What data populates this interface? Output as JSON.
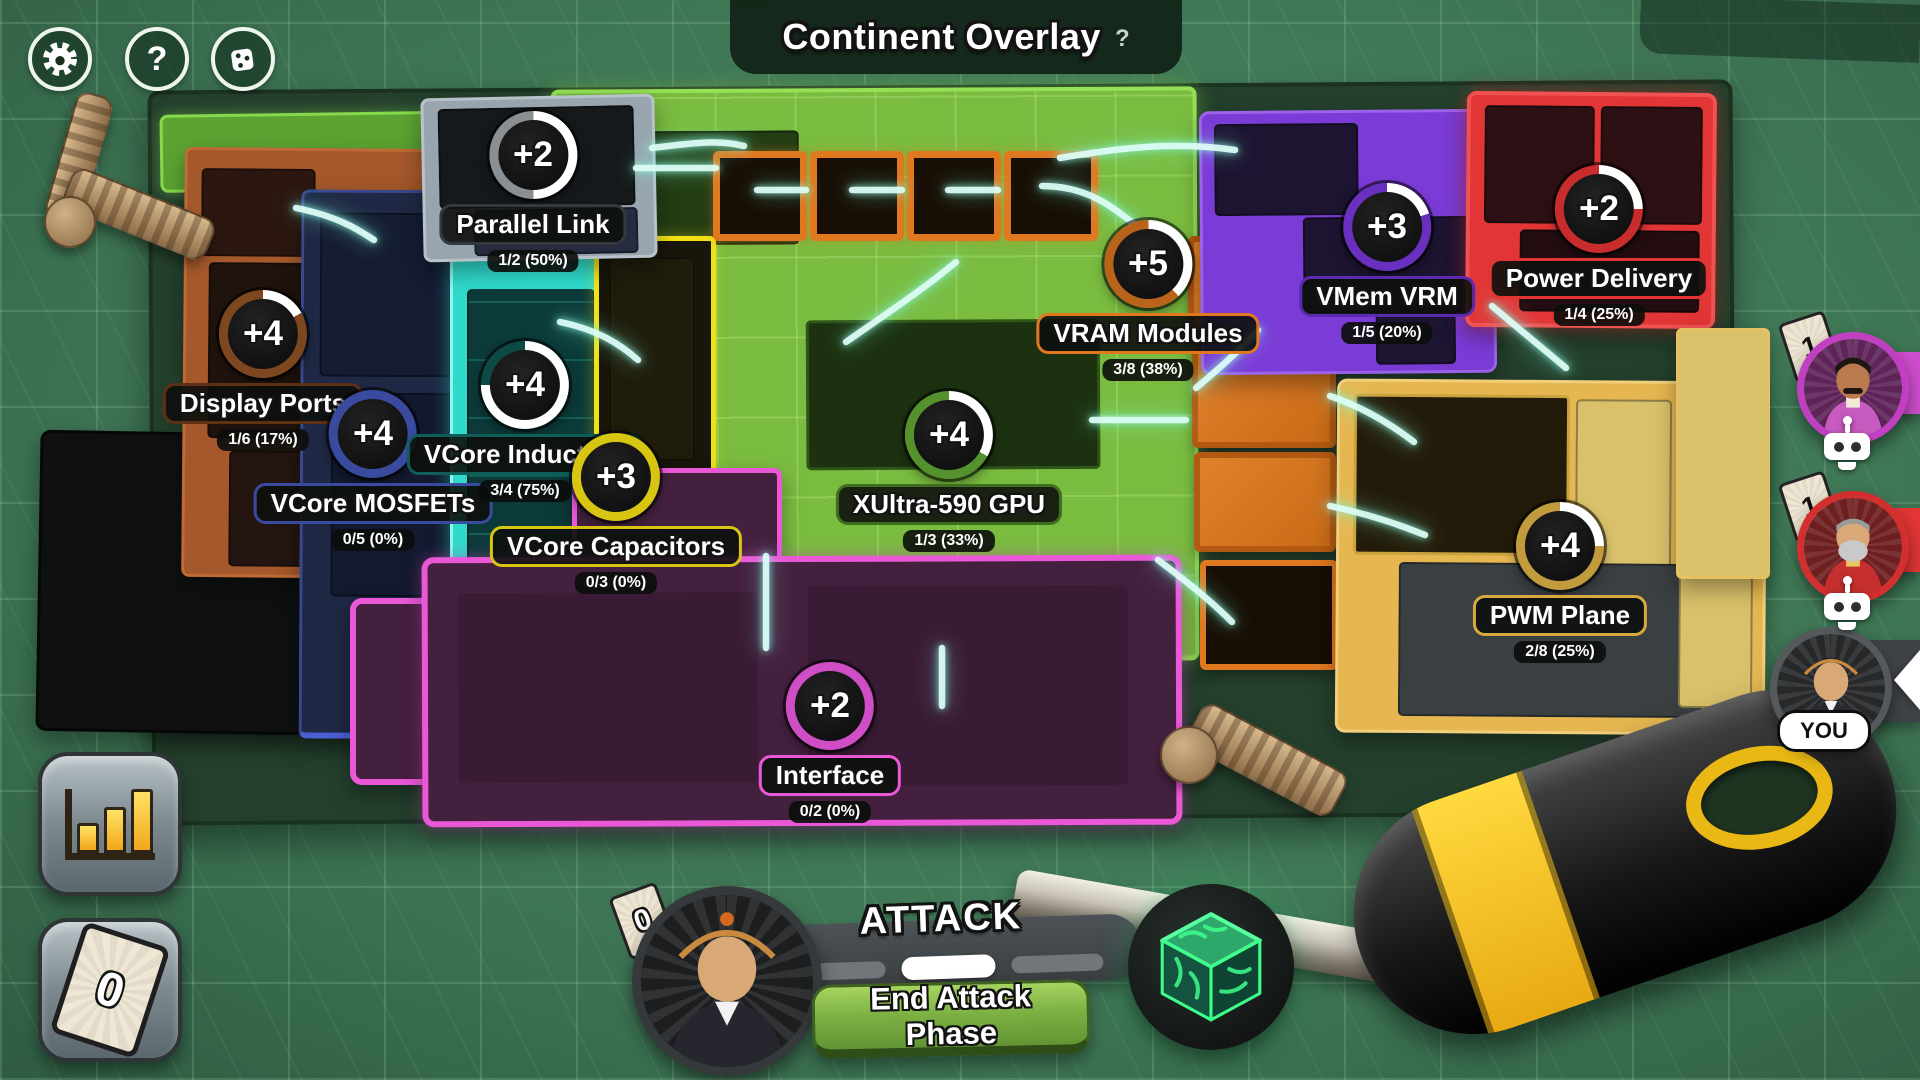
{
  "header": {
    "title": "Continent Overlay",
    "help": "?"
  },
  "toolbar": {
    "help_glyph": "?"
  },
  "icons": {
    "toolbar": [
      "gear-icon",
      "help-icon",
      "dice-icon"
    ],
    "hud": [
      "stats-icon",
      "cards-icon",
      "die-icon"
    ],
    "players": [
      "robot-icon",
      "chevron-left-icon"
    ]
  },
  "regions": [
    {
      "id": "parallel-link",
      "name": "Parallel Link",
      "bonus": "+2",
      "progress": "1/2 (50%)",
      "pct": 50,
      "ring": "#8a8f93",
      "accent": "#33393d"
    },
    {
      "id": "display-ports",
      "name": "Display Ports",
      "bonus": "+4",
      "progress": "1/6 (17%)",
      "pct": 17,
      "ring": "#7e4720",
      "accent": "#5e3014"
    },
    {
      "id": "vcore-mosfets",
      "name": "VCore MOSFETs",
      "bonus": "+4",
      "progress": "0/5 (0%)",
      "pct": 0,
      "ring": "#3a4a9e",
      "accent": "#3a4a9e"
    },
    {
      "id": "vcore-inductors",
      "name": "VCore Inductors",
      "bonus": "+4",
      "progress": "3/4 (75%)",
      "pct": 75,
      "ring": "#0d4a46",
      "accent": "#0f5e58"
    },
    {
      "id": "vcore-capacitors",
      "name": "VCore Capacitors",
      "bonus": "+3",
      "progress": "0/3 (0%)",
      "pct": 0,
      "ring": "#d8c512",
      "accent": "#d8c512"
    },
    {
      "id": "xultra-gpu",
      "name": "XUltra-590 GPU",
      "bonus": "+4",
      "progress": "1/3 (33%)",
      "pct": 33,
      "ring": "#55912c",
      "accent": "#3f6e1f"
    },
    {
      "id": "vram-modules",
      "name": "VRAM Modules",
      "bonus": "+5",
      "progress": "3/8 (38%)",
      "pct": 38,
      "ring": "#b9641a",
      "accent": "#e07820"
    },
    {
      "id": "vmem-vrm",
      "name": "VMem VRM",
      "bonus": "+3",
      "progress": "1/5 (20%)",
      "pct": 20,
      "ring": "#6930bf",
      "accent": "#5a2bb0"
    },
    {
      "id": "power-delivery",
      "name": "Power Delivery",
      "bonus": "+2",
      "progress": "1/4 (25%)",
      "pct": 25,
      "ring": "#c92c2c",
      "accent": "#e23636"
    },
    {
      "id": "pwm-plane",
      "name": "PWM Plane",
      "bonus": "+4",
      "progress": "2/8 (25%)",
      "pct": 25,
      "ring": "#c19b3c",
      "accent": "#d8a93f"
    },
    {
      "id": "interface",
      "name": "Interface",
      "bonus": "+2",
      "progress": "0/2 (0%)",
      "pct": 0,
      "ring": "#cf4ec6",
      "accent": "#ea58d8"
    }
  ],
  "players": [
    {
      "cards": "1",
      "type": "bot",
      "frame_color": "#c13fc1"
    },
    {
      "cards": "1",
      "type": "bot",
      "frame_color": "#d32f2f"
    },
    {
      "label": "YOU",
      "type": "you",
      "frame_color": "#56595c"
    }
  ],
  "hud": {
    "phase_title": "ATTACK",
    "end_phase_button": "End Attack Phase",
    "player_card_count": "0",
    "hand_card_count": "0"
  }
}
